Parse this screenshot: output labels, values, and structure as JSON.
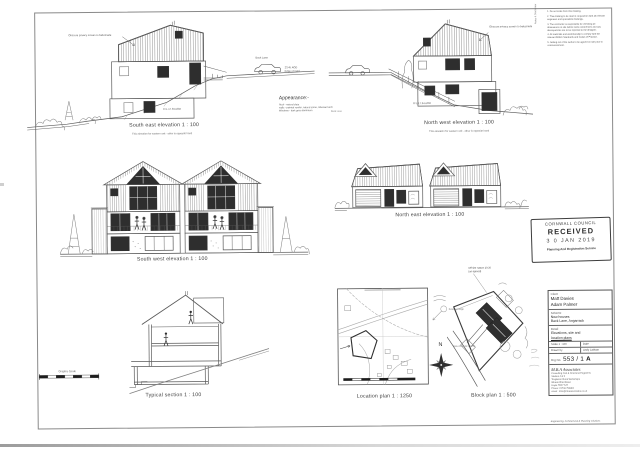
{
  "colors": {
    "paper": "#ffffff",
    "ink": "#555555",
    "window_fill": "#2e2e2e",
    "stamp_ink": "#3d3d3d"
  },
  "labels": {
    "south_east": "South east elevation  1 : 100",
    "south_east_sub": "This elevation for western unit - other is opposite hand",
    "north_west": "North west elevation  1 : 100",
    "north_west_sub": "This elevation for western unit - other is opposite hand",
    "south_west": "South west elevation  1 : 100",
    "north_east": "North east elevation  1 : 100",
    "section": "Typical section  1 : 100",
    "location": "Location plan  1 : 1250",
    "block": "Block plan  1 : 500",
    "graphic_scale": "Graphic Scale"
  },
  "appearance": {
    "title": "Appearance:-",
    "line1": "Roof - natural slate",
    "line2": "walls - painted render, natural stone, Siberian larch",
    "line3": "Windows - dark grey aluminium"
  },
  "annotations": {
    "privacy_screen": "Obscure privacy screen to balustrade",
    "ffl": "FFL 17.94 AOD",
    "road_level": "23.45 AOD",
    "road_edge": "Edge of road",
    "back_lane": "Back Lane",
    "nw_road": "Back Lane",
    "compass_n": "N",
    "block_note_1": "Off site nature 20:20",
    "block_note_2": "(as agreed)",
    "block_access": "New vehicular access",
    "block_hedge": "Existing hedge"
  },
  "notes_panel": {
    "side_label": "Notes & Disclaimer",
    "items": [
      "1.  Do not scale from this drawing.",
      "2.  This drawing to be read in conjunction with all relevant engineers and specialists drawings.",
      "3.  The contractor is responsible for checking all dimensions on site before work commences and any discrepancies are to be reported to the designer.",
      "4.  All materials and workmanship to comply with the relevant British Standards and Codes of Practice.",
      "5.  Setting out of the works to be agreed on site prior to commencement."
    ]
  },
  "stamp": {
    "council": "CORNWALL COUNCIL",
    "received": "RECEIVED",
    "date": "3 0  JAN  2019",
    "service": "Planning And Registration Service"
  },
  "title_block": {
    "client_label": "Client",
    "client_1": "Matt Davies",
    "client_2": "Adam Palmer",
    "scheme_label": "Scheme",
    "scheme_1": "New houses",
    "scheme_2": "Back Lane, Angarrack",
    "detail_label": "Detail",
    "detail_1": "Elevations, site and",
    "detail_2": "location plans",
    "scale_label": "Scale   1 : 100",
    "date_label": "Date",
    "drawn_label": "Drawn by",
    "drawn_by": "Andy Latham",
    "drg_label": "Drg No.",
    "drg_no": "553 / 1",
    "drg_rev": "A",
    "firm": "M.B.A Associates",
    "firm_line_0": "Consulting Civil & Structural Engineers",
    "firm_line_1": "Studios 4 & 5",
    "firm_line_2": "Treglisson Rural Workshops",
    "firm_line_3": "Wheal Alfred Road",
    "firm_line_4": "Hayle  TR27 5JT",
    "firm_line_5": "Phone: 01736 753891",
    "firm_line_6": "email : mba@mbaassociates.co.uk",
    "footer": "Engineering, Architectural & Planning solutions"
  }
}
